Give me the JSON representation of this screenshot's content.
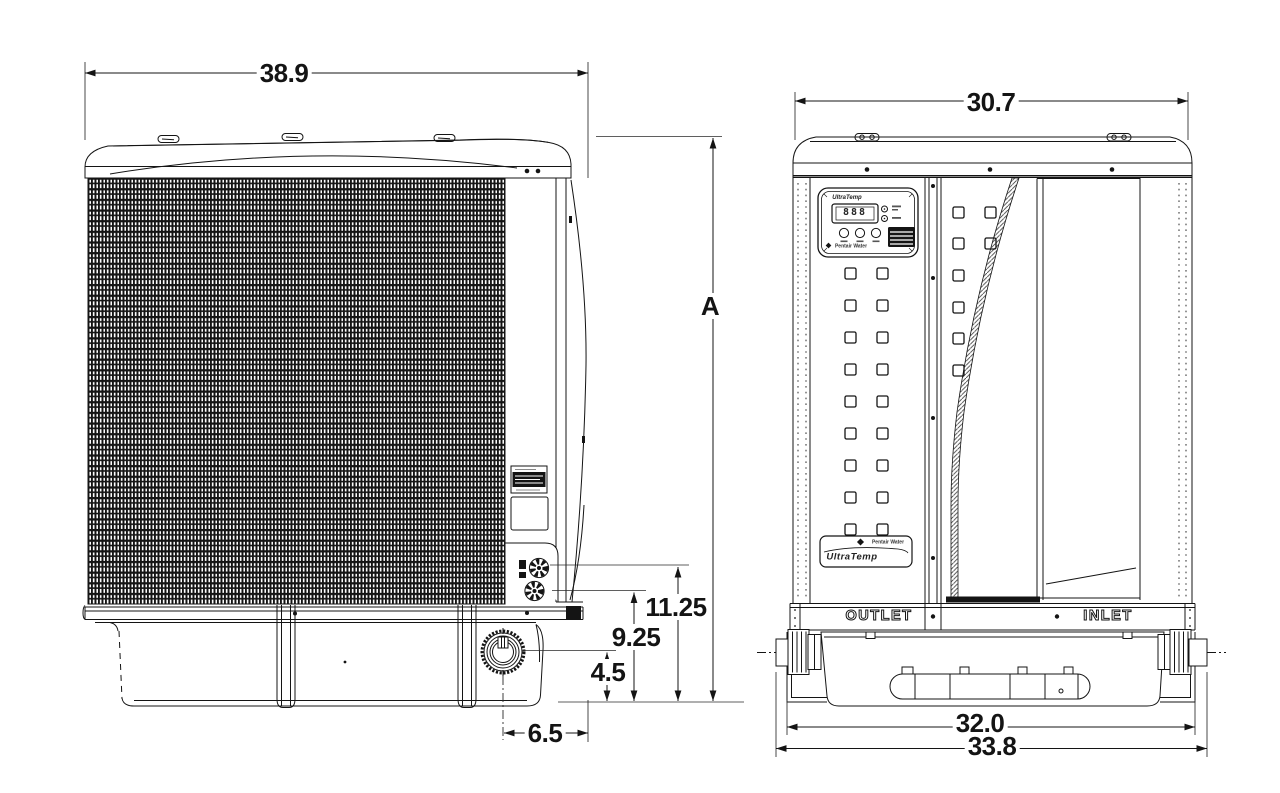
{
  "title": "heat-pump-dimension-drawing",
  "dims": {
    "side_width": "38.9",
    "front_width": "30.7",
    "height_ref": "A",
    "upper_port_height": "11.25",
    "lower_port_height": "9.25",
    "drain_height": "4.5",
    "drain_offset": "6.5",
    "base_feet_width": "32.0",
    "base_overall_width": "33.8"
  },
  "base_labels": {
    "outlet": "OUTLET",
    "inlet": "INLET"
  },
  "control_panel": {
    "brand": "UltraTemp",
    "display": "888",
    "maker": "Pentair Water"
  },
  "badge": {
    "logo": "UltraTemp",
    "maker": "Pentair Water"
  },
  "colors": {
    "line": "#141414",
    "background": "#ffffff"
  }
}
